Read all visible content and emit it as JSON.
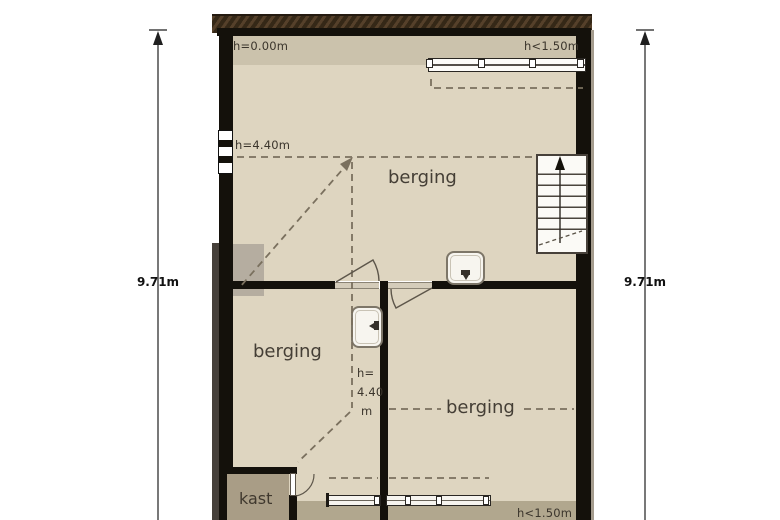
{
  "plan": {
    "type": "floor-plan",
    "height_labels": {
      "top_left": "h=0.00m",
      "top_right": "h<1.50m",
      "mid_left": "h=4.40m",
      "center_line1": "h=",
      "center_line2": "4.40",
      "center_line3": "m",
      "bottom_right": "h<1.50m"
    },
    "rooms": {
      "upper": "berging",
      "lower_left": "berging",
      "lower_right": "berging",
      "closet": "kast"
    },
    "dimensions": {
      "left": "9.71m",
      "right": "9.71m"
    },
    "fixtures": [
      "staircase",
      "sink",
      "sink",
      "radiator",
      "radiator",
      "window",
      "roof-window-bar",
      "door",
      "door",
      "closet-door"
    ],
    "colors": {
      "floor": "#ded5c0",
      "floor_entry_strip": "#cbc2ac",
      "floor_low_headroom_strip": "#b1a78e",
      "closet_floor": "#a99d86",
      "wall": "#14110b",
      "wall_hatch_brown": "#45321f",
      "contour_dash": "#7a705e",
      "background": "#ffffff"
    }
  }
}
